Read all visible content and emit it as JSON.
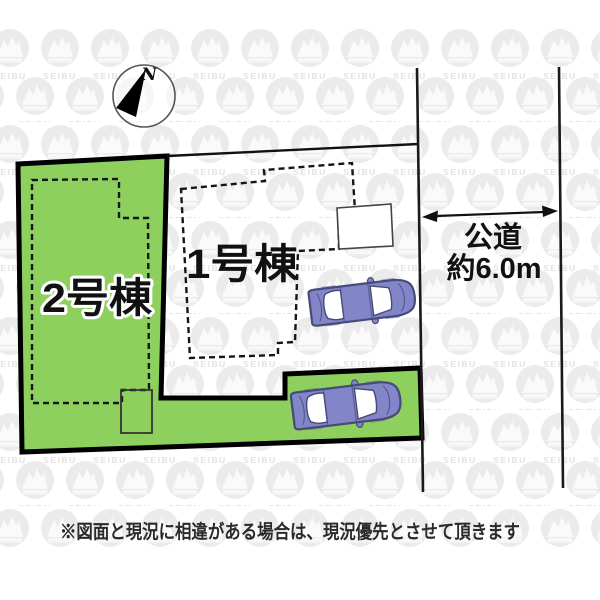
{
  "plan": {
    "lot1_label": "1号棟",
    "lot2_label": "2号棟",
    "road": {
      "name": "公道",
      "width_value": "約6.0m"
    },
    "compass_label": "N",
    "watermark_text": "SEIBU",
    "disclaimer": "※図面と現況に相違がある場合は、現況優先とさせて頂きます",
    "colors": {
      "lot_green": "#8ed05e",
      "car_body": "#8286c9",
      "car_window": "#ffffff",
      "car_outline": "#474b78",
      "line_black": "#111111"
    }
  }
}
